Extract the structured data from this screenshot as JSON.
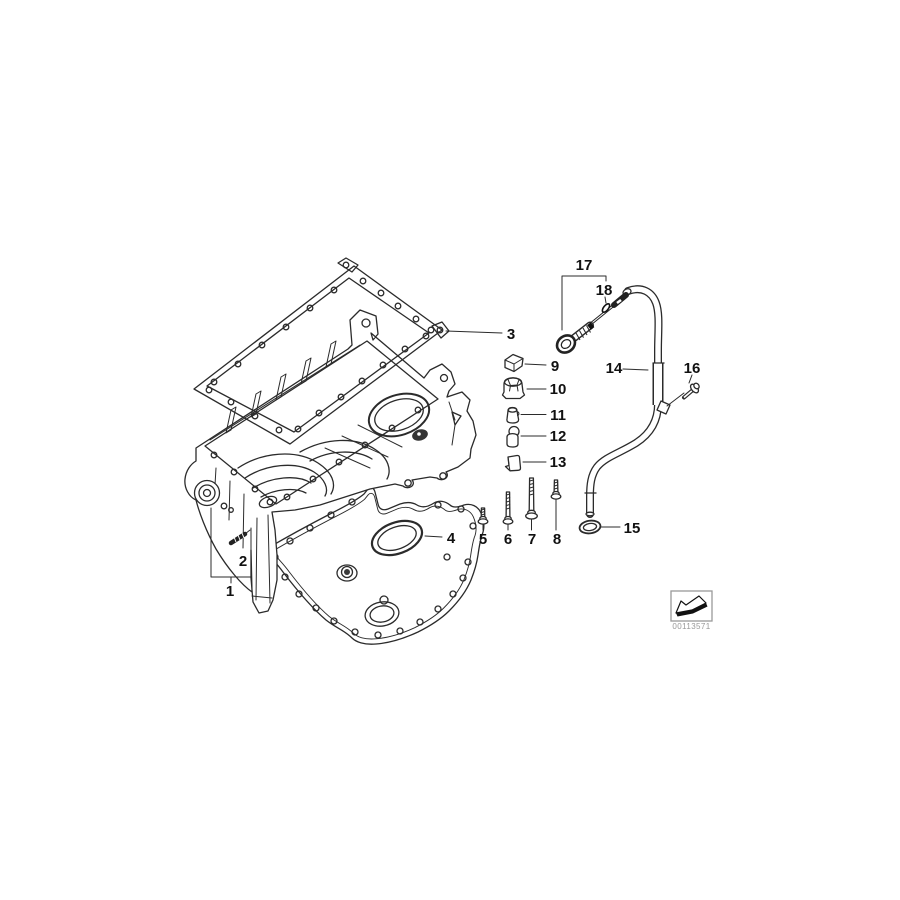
{
  "diagram": {
    "callouts": [
      "1",
      "2",
      "3",
      "4",
      "5",
      "6",
      "7",
      "8",
      "9",
      "10",
      "11",
      "12",
      "13",
      "14",
      "15",
      "16",
      "17",
      "18"
    ],
    "image_id": "00113571",
    "colors": {
      "background": "#ffffff",
      "line": "#2b2b2b",
      "label": "#111111",
      "id_text": "#999999"
    }
  }
}
